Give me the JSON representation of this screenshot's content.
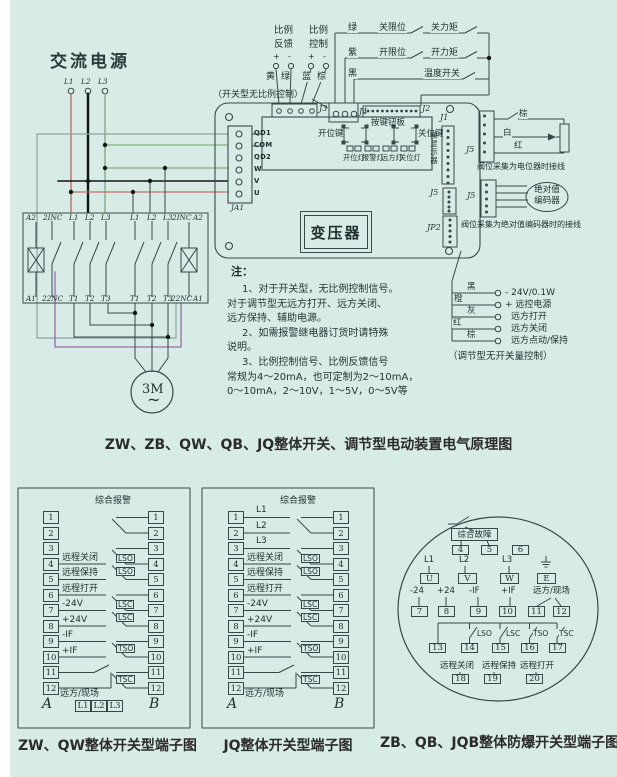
{
  "main": {
    "ac_power": "交流电源",
    "phases": [
      "L1",
      "L2",
      "L3"
    ],
    "prop": {
      "l1": "比例",
      "l2": "反馈",
      "l3": "比例",
      "l4": "控制",
      "signs": [
        "+",
        "-",
        "+",
        "-"
      ],
      "wire_colors": [
        "黄",
        "绿",
        "蓝",
        "棕"
      ]
    },
    "switch_note": "（开关型无比例控制）",
    "limit": {
      "row1_color": "绿",
      "row1_sw1": "关限位",
      "row1_sw2": "关力矩",
      "row2_color": "紫",
      "row2_sw1": "开限位",
      "row2_sw2": "开力矩",
      "row3_color": "黑",
      "row3_sw1": "温度开关"
    },
    "connectors": {
      "j3": "J3",
      "j4": "J4",
      "j2": "J2",
      "j1": "J1",
      "j5_board": "J5",
      "jp2": "JP2",
      "j5_pot": "J5",
      "j5_enc": "J5",
      "ja1": "JA1"
    },
    "ja1_pins": [
      "QD1",
      "COM",
      "QD2",
      "W",
      "V",
      "U"
    ],
    "button_board": {
      "label": "按键钮板",
      "open_key": "开位键",
      "close_key": "关位键",
      "lights": [
        "开位灯",
        "报警灯",
        "远方灯",
        "关位灯"
      ]
    },
    "display_label": "接显示器",
    "transformer": "变压器",
    "pot": {
      "wire_colors": [
        "棕",
        "白",
        "红"
      ],
      "note": "阀位采集为电位器时接线"
    },
    "encoder": {
      "line1": "绝对值",
      "line2": "编码器",
      "note": "阀位采集为绝对值编码器时的接线"
    },
    "remote": {
      "rows": [
        {
          "color": "黑",
          "text": "- 24V/0.1W"
        },
        {
          "color": "橙",
          "text": "+ 远控电源"
        },
        {
          "color": "灰",
          "text": "远方打开"
        },
        {
          "color": "红",
          "text": "远方关闭"
        },
        {
          "color": "棕",
          "text": "远方点动/保持"
        }
      ],
      "note": "（调节型无开关量控制）"
    },
    "terminal_top": [
      "A2",
      "2INC",
      "L1",
      "L2",
      "L3",
      "L1",
      "L2",
      "L3",
      "2INC",
      "A2"
    ],
    "terminal_bottom": [
      "A1",
      "22NC",
      "T1",
      "T2",
      "T3",
      "T1",
      "T2",
      "T3",
      "22NC",
      "A1"
    ],
    "motor": {
      "label": "3M",
      "wave": "~"
    },
    "notes": {
      "head": "注：",
      "lines": [
        "1、对于开关型，无比例控制信号。",
        "对于调节型无远方打开、远方关闭、",
        "远方保持、辅助电源。",
        "2、如需报警继电器订货时请特殊",
        "说明。",
        "3、比例控制信号、比例反馈信号",
        "常规为4～20mA，也可定制为2～10mA，",
        "0～10mA，2～10V，1～5V，0～5V等"
      ]
    },
    "title": "ZW、ZB、QW、QB、JQ整体开关、调节型电动装置电气原理图"
  },
  "terminal_common": {
    "numbers": [
      "1",
      "2",
      "3",
      "4",
      "5",
      "6",
      "7",
      "8",
      "9",
      "10",
      "11",
      "12"
    ],
    "alarm": "综合报警",
    "left_labels": [
      "远程关闭",
      "远程保持",
      "远程打开",
      "-24V",
      "+24V",
      "-IF",
      "+IF"
    ],
    "right_labels": [
      "LSO",
      "LSO",
      "LSC",
      "LSC",
      "TSO",
      "TSC"
    ],
    "remote_local": "远方/现场",
    "col_a": "A",
    "col_b": "B"
  },
  "panel1": {
    "title": "ZW、QW整体开关型端子图",
    "phase_box": [
      "L1",
      "L2",
      "L3"
    ]
  },
  "panel2": {
    "title": "JQ整体开关型端子图",
    "phase_rows": [
      "L1",
      "L2",
      "L3"
    ]
  },
  "panel3": {
    "title": "ZB、QB、JQB整体防爆开关型端子图",
    "fault": "综合故障",
    "row1_boxes": [
      "4",
      "5",
      "6"
    ],
    "row2_labels": [
      "L1",
      "L2",
      "L3"
    ],
    "row2_boxes": [
      "U",
      "V",
      "W",
      "E"
    ],
    "row3_labels": [
      "-24",
      "+24",
      "-IF",
      "+IF"
    ],
    "remote_local": "远方/现场",
    "row3_boxes": [
      "7",
      "8",
      "9",
      "10",
      "11",
      "12"
    ],
    "row4_labels": [
      "LSO",
      "LSC",
      "TSO",
      "TSC"
    ],
    "row4_boxes": [
      "13",
      "14",
      "15",
      "16",
      "17"
    ],
    "row5_labels": [
      "远程关闭",
      "远程保持",
      "远程打开"
    ],
    "row5_boxes": [
      "18",
      "19",
      "20"
    ]
  },
  "colors": {
    "background": "#d8ece7",
    "line": "#37474a",
    "wire_red": "#bf6a6a",
    "wire_green": "#7fae7f",
    "wire_purple": "#9a6aa8",
    "wire_gray": "#8fa3a3",
    "wire_black": "#141414"
  }
}
